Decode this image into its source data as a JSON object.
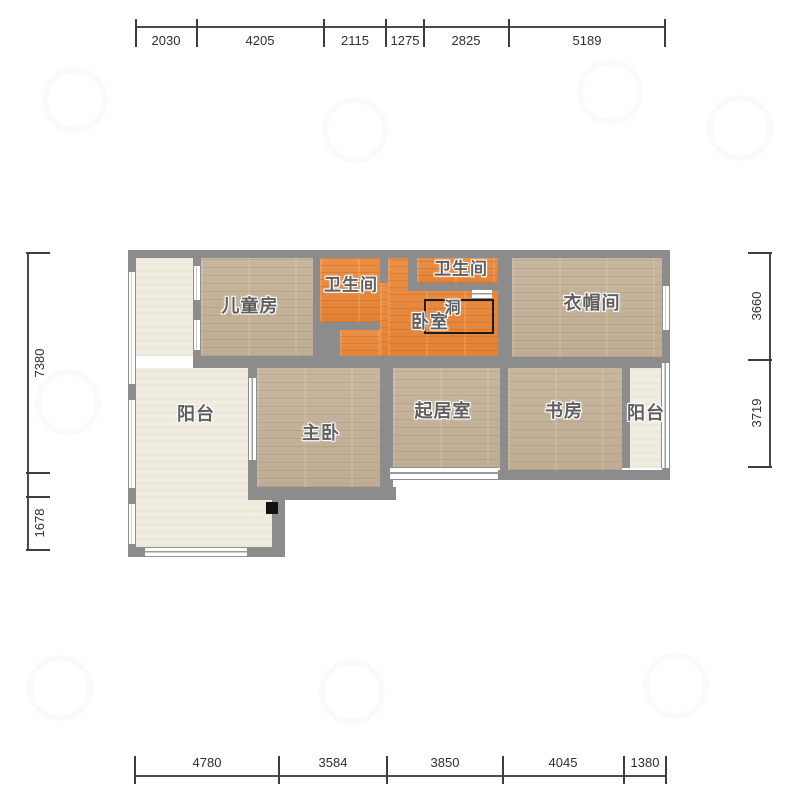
{
  "document": {
    "type": "apartment-floor-plan",
    "language": "zh-CN"
  },
  "colors": {
    "wall": "#8c8c8c",
    "wood_floor": "#c7b69d",
    "orange_floor": "#ec8c3e",
    "light_floor": "#f0ecdf",
    "dim_line": "#4a4a4a",
    "dim_text": "#2e2e2e",
    "room_label_text": "#5f5f5f",
    "background": "#ffffff"
  },
  "rooms": [
    {
      "id": "children-room",
      "label": "儿童房",
      "cx": 250,
      "cy": 305,
      "size": 18
    },
    {
      "id": "bathroom-left",
      "label": "卫生间",
      "cx": 351,
      "cy": 283,
      "size": 17
    },
    {
      "id": "bathroom-right",
      "label": "卫生间",
      "cx": 461,
      "cy": 267,
      "size": 17
    },
    {
      "id": "bedroom",
      "label": "卧室",
      "cx": 430,
      "cy": 321,
      "size": 18
    },
    {
      "id": "hole",
      "label": "洞",
      "cx": 453,
      "cy": 306,
      "size": 16
    },
    {
      "id": "cloakroom",
      "label": "衣帽间",
      "cx": 592,
      "cy": 302,
      "size": 18
    },
    {
      "id": "balcony-left",
      "label": "阳台",
      "cx": 196,
      "cy": 413,
      "size": 18
    },
    {
      "id": "master-bedroom",
      "label": "主卧",
      "cx": 321,
      "cy": 432,
      "size": 18
    },
    {
      "id": "living-room",
      "label": "起居室",
      "cx": 443,
      "cy": 410,
      "size": 18
    },
    {
      "id": "study",
      "label": "书房",
      "cx": 564,
      "cy": 410,
      "size": 18
    },
    {
      "id": "balcony-right",
      "label": "阳台",
      "cx": 646,
      "cy": 412,
      "size": 18
    }
  ],
  "geometry": {
    "floors": [
      {
        "room": "balcony-left-upper",
        "type": "light",
        "x": 136,
        "y": 258,
        "w": 57,
        "h": 98
      },
      {
        "room": "balcony-left-lower",
        "type": "light",
        "x": 136,
        "y": 368,
        "w": 112,
        "h": 179
      },
      {
        "room": "balcony-left-ext",
        "type": "light",
        "x": 248,
        "y": 500,
        "w": 24,
        "h": 47
      },
      {
        "room": "children-room",
        "type": "wood",
        "x": 201,
        "y": 258,
        "w": 112,
        "h": 98
      },
      {
        "room": "bathroom-left",
        "type": "orange",
        "x": 320,
        "y": 258,
        "w": 60,
        "h": 64
      },
      {
        "room": "bedroom-main",
        "type": "orange",
        "x": 388,
        "y": 258,
        "w": 110,
        "h": 100
      },
      {
        "room": "bedroom-west",
        "type": "orange",
        "x": 340,
        "y": 330,
        "w": 48,
        "h": 28
      },
      {
        "room": "bedroom-door-strip",
        "type": "orange",
        "x": 380,
        "y": 283,
        "w": 8,
        "h": 73
      },
      {
        "room": "bathroom-right",
        "type": "orange",
        "x": 417,
        "y": 258,
        "w": 81,
        "h": 25
      },
      {
        "room": "cloakroom",
        "type": "wood",
        "x": 512,
        "y": 258,
        "w": 150,
        "h": 99
      },
      {
        "room": "master-bedroom",
        "type": "wood",
        "x": 257,
        "y": 368,
        "w": 123,
        "h": 119
      },
      {
        "room": "living-room",
        "type": "wood",
        "x": 393,
        "y": 368,
        "w": 107,
        "h": 100
      },
      {
        "room": "study",
        "type": "wood",
        "x": 508,
        "y": 368,
        "w": 114,
        "h": 102
      },
      {
        "room": "balcony-right",
        "type": "light",
        "x": 630,
        "y": 368,
        "w": 32,
        "h": 100
      }
    ],
    "walls": [
      {
        "x": 128,
        "y": 250,
        "w": 542,
        "h": 8
      },
      {
        "x": 128,
        "y": 250,
        "w": 8,
        "h": 307
      },
      {
        "x": 662,
        "y": 250,
        "w": 8,
        "h": 230
      },
      {
        "x": 386,
        "y": 470,
        "w": 284,
        "h": 10
      },
      {
        "x": 128,
        "y": 547,
        "w": 157,
        "h": 10
      },
      {
        "x": 248,
        "y": 487,
        "w": 148,
        "h": 13
      },
      {
        "x": 272,
        "y": 500,
        "w": 13,
        "h": 47
      },
      {
        "x": 193,
        "y": 258,
        "w": 8,
        "h": 98
      },
      {
        "x": 248,
        "y": 358,
        "w": 9,
        "h": 129
      },
      {
        "x": 313,
        "y": 258,
        "w": 7,
        "h": 64
      },
      {
        "x": 313,
        "y": 322,
        "w": 27,
        "h": 46
      },
      {
        "x": 340,
        "y": 322,
        "w": 40,
        "h": 8
      },
      {
        "x": 380,
        "y": 258,
        "w": 8,
        "h": 25
      },
      {
        "x": 408,
        "y": 258,
        "w": 9,
        "h": 25
      },
      {
        "x": 408,
        "y": 283,
        "w": 90,
        "h": 8
      },
      {
        "x": 498,
        "y": 258,
        "w": 14,
        "h": 99
      },
      {
        "x": 193,
        "y": 356,
        "w": 305,
        "h": 12
      },
      {
        "x": 498,
        "y": 357,
        "w": 164,
        "h": 11
      },
      {
        "x": 380,
        "y": 368,
        "w": 13,
        "h": 119
      },
      {
        "x": 500,
        "y": 368,
        "w": 8,
        "h": 102
      },
      {
        "x": 622,
        "y": 368,
        "w": 8,
        "h": 100
      }
    ],
    "windows": [
      {
        "x": 193,
        "y": 266,
        "w": 8,
        "h": 34,
        "o": "v"
      },
      {
        "x": 193,
        "y": 320,
        "w": 8,
        "h": 30,
        "o": "v"
      },
      {
        "x": 128,
        "y": 272,
        "w": 8,
        "h": 112,
        "o": "v"
      },
      {
        "x": 128,
        "y": 400,
        "w": 8,
        "h": 88,
        "o": "v"
      },
      {
        "x": 128,
        "y": 504,
        "w": 8,
        "h": 40,
        "o": "v"
      },
      {
        "x": 145,
        "y": 547,
        "w": 102,
        "h": 10,
        "o": "h"
      },
      {
        "x": 248,
        "y": 378,
        "w": 9,
        "h": 82,
        "o": "v"
      },
      {
        "x": 390,
        "y": 467,
        "w": 108,
        "h": 13,
        "o": "h"
      },
      {
        "x": 662,
        "y": 286,
        "w": 8,
        "h": 44,
        "o": "v"
      },
      {
        "x": 661,
        "y": 363,
        "w": 9,
        "h": 105,
        "o": "v"
      },
      {
        "x": 472,
        "y": 289,
        "w": 20,
        "h": 10,
        "o": "h"
      }
    ],
    "hole_rect": {
      "x": 424,
      "y": 299,
      "w": 70,
      "h": 35
    },
    "black_square": {
      "x": 266,
      "y": 502,
      "w": 12,
      "h": 12
    }
  },
  "dimensions": {
    "top": {
      "orientation": "horizontal",
      "line_pos": 27,
      "from": 136,
      "to": 665,
      "ticks": [
        136,
        197,
        324,
        386,
        424,
        509,
        665
      ],
      "label_side": "below",
      "segments": [
        {
          "value": "2030",
          "c": 166
        },
        {
          "value": "4205",
          "c": 260
        },
        {
          "value": "2115",
          "c": 355
        },
        {
          "value": "1275",
          "c": 405
        },
        {
          "value": "2825",
          "c": 466
        },
        {
          "value": "5189",
          "c": 587
        }
      ]
    },
    "bottom": {
      "orientation": "horizontal",
      "line_pos": 776,
      "from": 135,
      "to": 666,
      "ticks": [
        135,
        279,
        387,
        503,
        624,
        666
      ],
      "label_side": "above",
      "segments": [
        {
          "value": "4780",
          "c": 207
        },
        {
          "value": "3584",
          "c": 333
        },
        {
          "value": "3850",
          "c": 445
        },
        {
          "value": "4045",
          "c": 563
        },
        {
          "value": "1380",
          "c": 645
        }
      ]
    },
    "left": {
      "orientation": "vertical",
      "line_pos": 28,
      "from": 253,
      "to": 550,
      "ticks": [
        253,
        473,
        497,
        550
      ],
      "label_side": "right",
      "segments": [
        {
          "value": "7380",
          "c": 363
        },
        {
          "value": "1678",
          "c": 523
        }
      ]
    },
    "right": {
      "orientation": "vertical",
      "line_pos": 770,
      "from": 253,
      "to": 467,
      "ticks": [
        253,
        360,
        467
      ],
      "label_side": "left",
      "segments": [
        {
          "value": "3660",
          "c": 306
        },
        {
          "value": "3719",
          "c": 413
        }
      ]
    }
  }
}
